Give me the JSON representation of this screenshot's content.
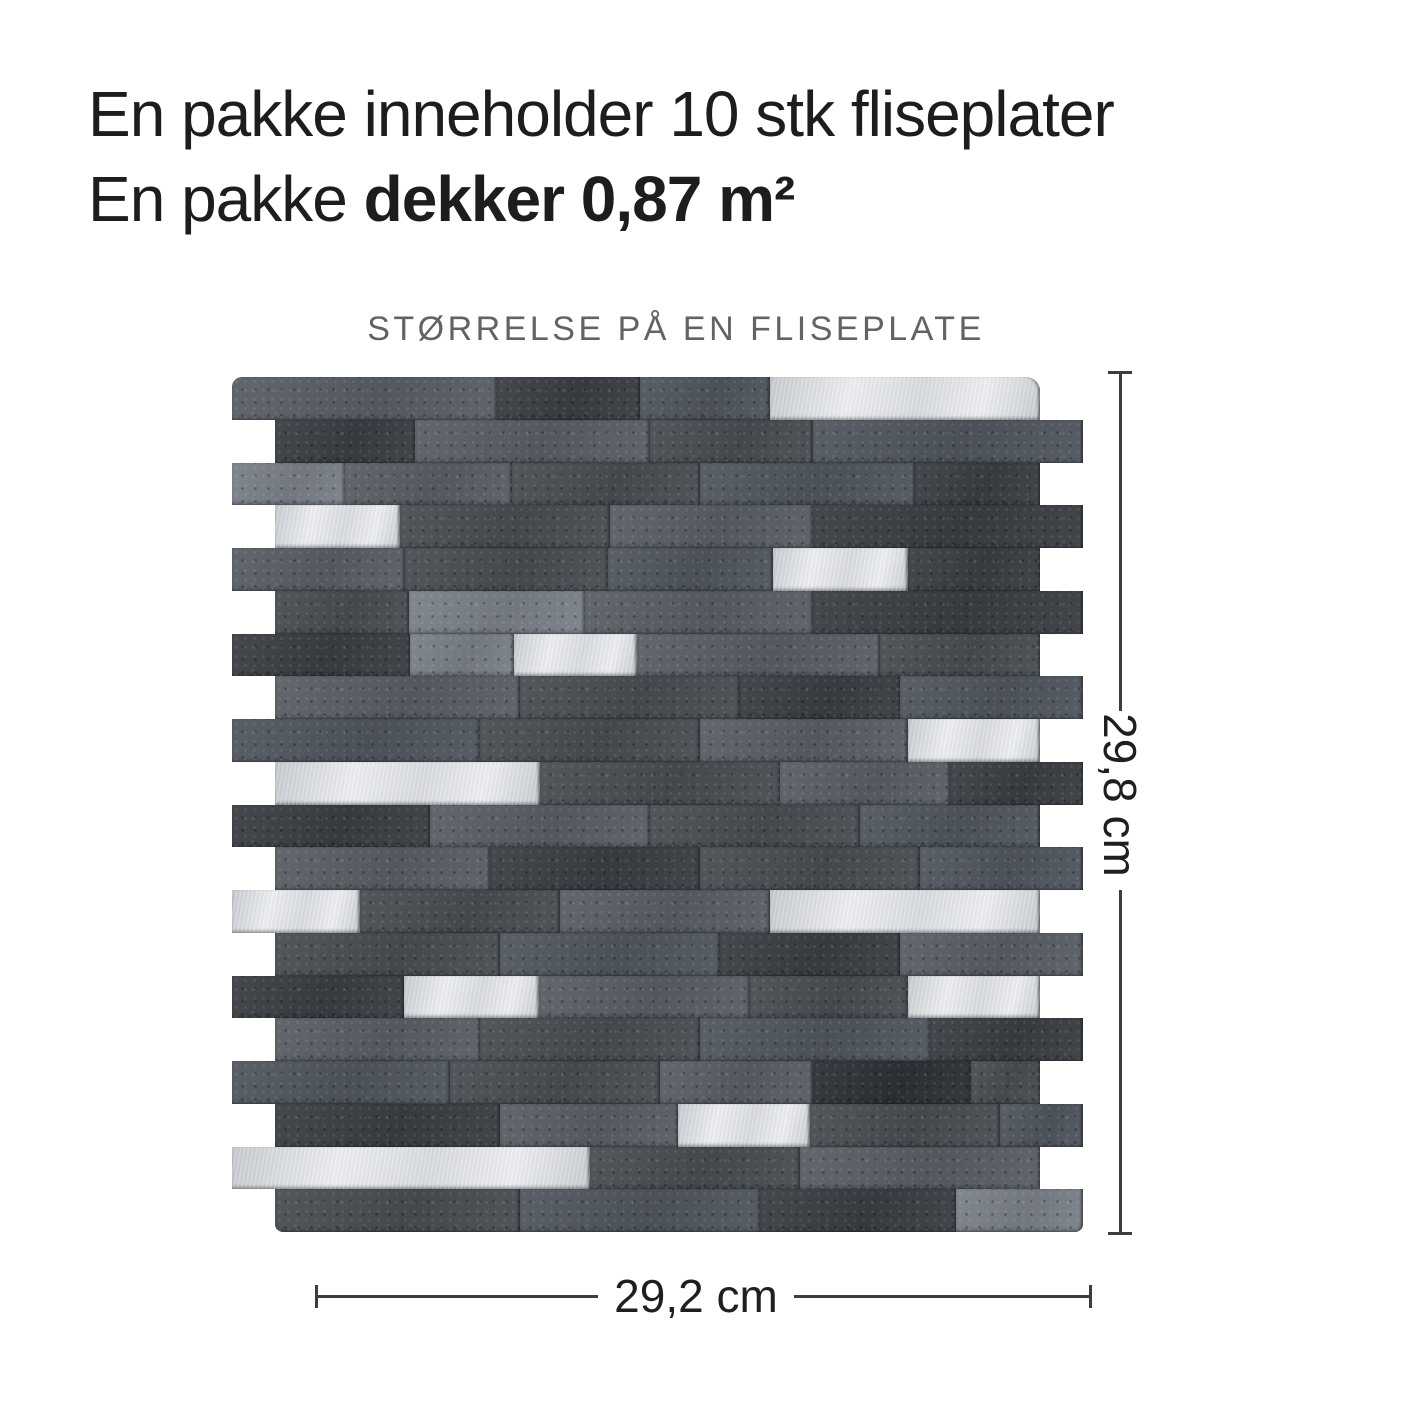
{
  "header": {
    "line1": "En pakke inneholder 10 stk fliseplater",
    "line2_regular": "En pakke ",
    "line2_bold": "dekker 0,87 m²"
  },
  "section": {
    "title": "STØRRELSE PÅ EN FLISEPLATE"
  },
  "dimensions": {
    "width_label": "29,2 cm",
    "height_label": "29,8 cm"
  },
  "colors": {
    "background": "#ffffff",
    "text_primary": "#1d1d1d",
    "text_muted": "#636363",
    "dim_line": "#3d3d3d",
    "silver_a": "#c6cace",
    "silver_b": "#eceef1",
    "silver_c": "#d7dade"
  },
  "tile_panel": {
    "indent_px": 43,
    "row_height_px": 42.75,
    "row_length_px": 808,
    "palette": {
      "dark1": "#4a4e53",
      "dark2": "#3b3f44",
      "darkest": "#2e3136",
      "mid": "#5a5f66",
      "mid2": "#515760",
      "light": "#7b818a"
    },
    "rows": [
      {
        "indent": 0,
        "bricks": [
          [
            265,
            "mid"
          ],
          [
            143,
            "dark2"
          ],
          [
            130,
            "mid2"
          ],
          [
            270,
            "silver"
          ]
        ]
      },
      {
        "indent": 1,
        "bricks": [
          [
            140,
            "dark2"
          ],
          [
            235,
            "mid"
          ],
          [
            163,
            "dark1"
          ],
          [
            270,
            "mid2"
          ]
        ]
      },
      {
        "indent": 0,
        "bricks": [
          [
            113,
            "light"
          ],
          [
            167,
            "mid"
          ],
          [
            188,
            "dark1"
          ],
          [
            215,
            "mid2"
          ],
          [
            125,
            "dark2"
          ]
        ]
      },
      {
        "indent": 1,
        "bricks": [
          [
            125,
            "silver"
          ],
          [
            210,
            "dark1"
          ],
          [
            203,
            "mid"
          ],
          [
            270,
            "dark2"
          ]
        ]
      },
      {
        "indent": 0,
        "bricks": [
          [
            173,
            "mid"
          ],
          [
            203,
            "dark1"
          ],
          [
            165,
            "mid2"
          ],
          [
            135,
            "silver"
          ],
          [
            132,
            "dark2"
          ]
        ]
      },
      {
        "indent": 1,
        "bricks": [
          [
            134,
            "dark1"
          ],
          [
            176,
            "light"
          ],
          [
            228,
            "mid"
          ],
          [
            270,
            "dark2"
          ]
        ]
      },
      {
        "indent": 0,
        "bricks": [
          [
            178,
            "dark2"
          ],
          [
            104,
            "light"
          ],
          [
            123,
            "silver"
          ],
          [
            243,
            "mid"
          ],
          [
            160,
            "dark1"
          ]
        ]
      },
      {
        "indent": 1,
        "bricks": [
          [
            245,
            "mid"
          ],
          [
            220,
            "dark1"
          ],
          [
            160,
            "dark2"
          ],
          [
            183,
            "mid2"
          ]
        ]
      },
      {
        "indent": 0,
        "bricks": [
          [
            248,
            "mid2"
          ],
          [
            220,
            "dark1"
          ],
          [
            208,
            "mid"
          ],
          [
            132,
            "silver"
          ]
        ]
      },
      {
        "indent": 1,
        "bricks": [
          [
            265,
            "silver"
          ],
          [
            240,
            "dark1"
          ],
          [
            170,
            "mid"
          ],
          [
            133,
            "dark2"
          ]
        ]
      },
      {
        "indent": 0,
        "bricks": [
          [
            198,
            "dark2"
          ],
          [
            220,
            "mid"
          ],
          [
            210,
            "dark1"
          ],
          [
            180,
            "mid2"
          ]
        ]
      },
      {
        "indent": 1,
        "bricks": [
          [
            215,
            "mid"
          ],
          [
            210,
            "dark2"
          ],
          [
            220,
            "dark1"
          ],
          [
            163,
            "mid2"
          ]
        ]
      },
      {
        "indent": 0,
        "bricks": [
          [
            128,
            "silver"
          ],
          [
            200,
            "dark1"
          ],
          [
            210,
            "mid"
          ],
          [
            270,
            "silver"
          ]
        ]
      },
      {
        "indent": 1,
        "bricks": [
          [
            225,
            "dark1"
          ],
          [
            220,
            "mid2"
          ],
          [
            180,
            "dark2"
          ],
          [
            183,
            "mid"
          ]
        ]
      },
      {
        "indent": 0,
        "bricks": [
          [
            172,
            "dark2"
          ],
          [
            135,
            "silver"
          ],
          [
            211,
            "mid"
          ],
          [
            158,
            "dark1"
          ],
          [
            132,
            "silver"
          ]
        ]
      },
      {
        "indent": 1,
        "bricks": [
          [
            205,
            "mid"
          ],
          [
            220,
            "dark1"
          ],
          [
            230,
            "mid2"
          ],
          [
            153,
            "dark2"
          ]
        ]
      },
      {
        "indent": 0,
        "bricks": [
          [
            218,
            "mid2"
          ],
          [
            210,
            "dark1"
          ],
          [
            153,
            "mid"
          ],
          [
            158,
            "darkest"
          ],
          [
            69,
            "dark1"
          ]
        ]
      },
      {
        "indent": 1,
        "bricks": [
          [
            225,
            "dark2"
          ],
          [
            178,
            "mid"
          ],
          [
            132,
            "silver"
          ],
          [
            190,
            "dark1"
          ],
          [
            83,
            "mid2"
          ]
        ]
      },
      {
        "indent": 0,
        "bricks": [
          [
            358,
            "silver"
          ],
          [
            210,
            "dark1"
          ],
          [
            240,
            "mid"
          ]
        ]
      },
      {
        "indent": 1,
        "bricks": [
          [
            245,
            "dark1"
          ],
          [
            240,
            "mid2"
          ],
          [
            196,
            "dark2"
          ],
          [
            127,
            "light"
          ]
        ]
      }
    ]
  }
}
